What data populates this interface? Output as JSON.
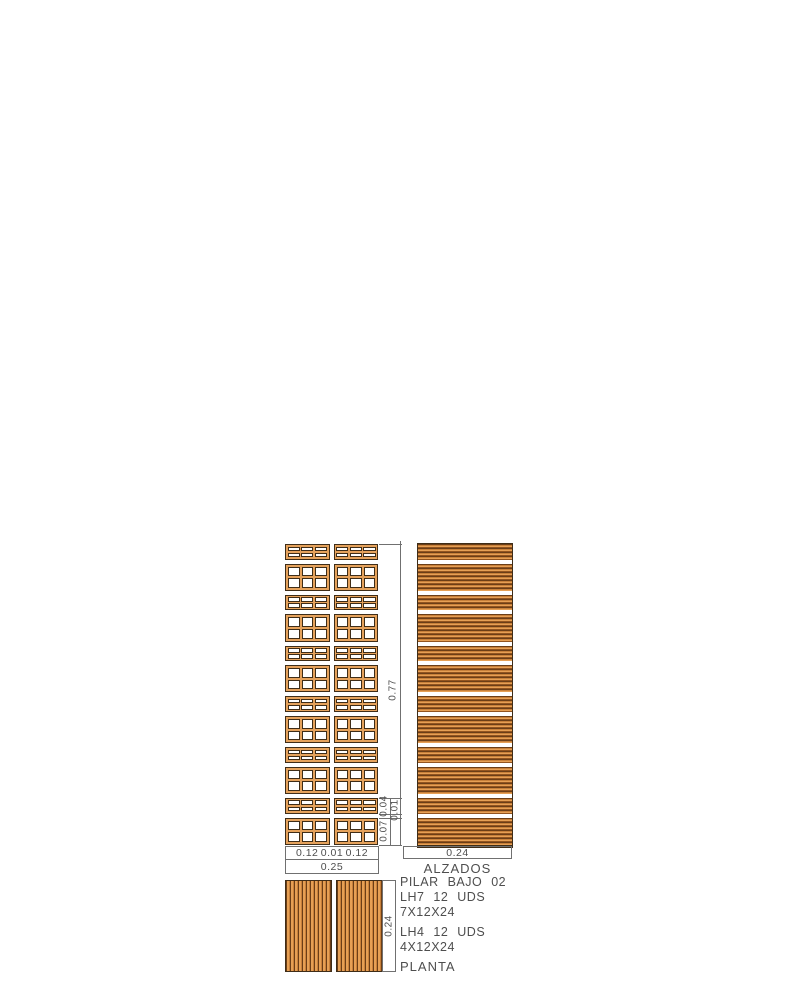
{
  "drawing": {
    "title_block": {
      "name": "PILAR BAJO 02",
      "lh7_units": "LH7 12 UDS",
      "lh7_size": "7X12X24",
      "lh4_units": "LH4 12 UDS",
      "lh4_size": "4X12X24"
    },
    "labels": {
      "elevations": "ALZADOS",
      "plan": "PLANTA"
    },
    "dimensions": {
      "front_width_parts": [
        "0.12",
        "0.01",
        "0.12"
      ],
      "front_width_total": "0.25",
      "side_width": "0.24",
      "height_total": "0.77",
      "course_lh4": "0.04",
      "joint": "0.01",
      "course_lh7": "0.07",
      "plan_depth": "0.24"
    },
    "courses_top_to_bottom": [
      "LH4",
      "LH7",
      "LH4",
      "LH7",
      "LH4",
      "LH7",
      "LH4",
      "LH7",
      "LH4",
      "LH7",
      "LH4",
      "LH7"
    ],
    "course_heights_m": {
      "LH7": 0.07,
      "LH4": 0.04,
      "joint": 0.01
    },
    "colors": {
      "brick": "#E5A25C",
      "outline": "#3F2D18",
      "stripe_dark": "#6B3E17",
      "stripe_mid": "#C8803A",
      "stripe_light": "#E6A055",
      "stripe_deep": "#93541F",
      "dim_line": "#707070",
      "text": "#4E4E4E"
    }
  }
}
